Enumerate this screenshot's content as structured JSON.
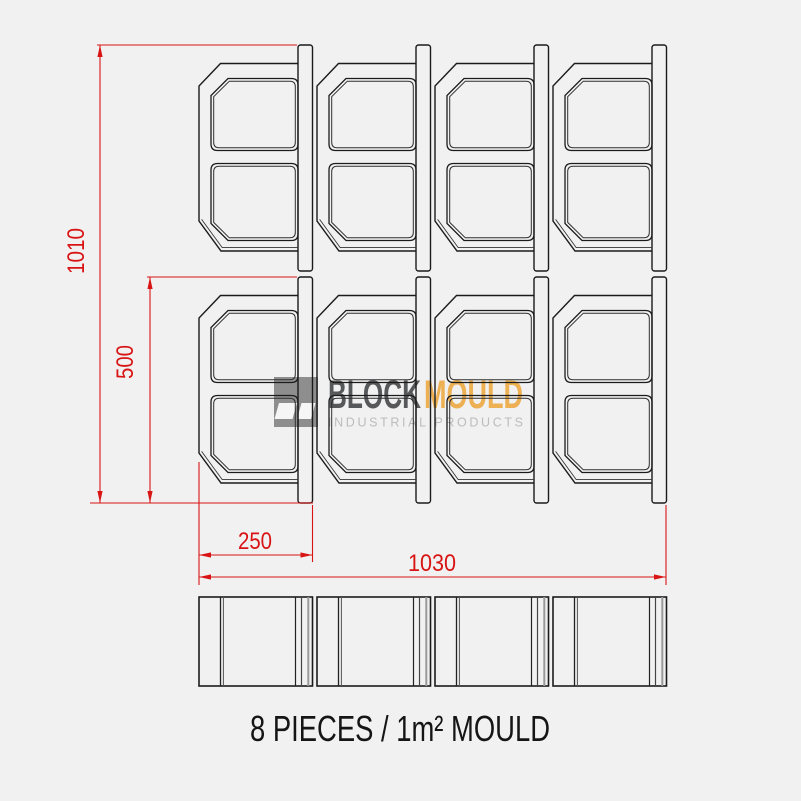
{
  "drawing": {
    "caption": "8 PIECES / 1m² MOULD",
    "grid": {
      "rows": 2,
      "columns": 4,
      "pieces_total": 8
    },
    "dimensions": {
      "overall_height": "1010",
      "piece_height": "500",
      "piece_width": "250",
      "overall_width": "1030"
    },
    "colors": {
      "background": "#f1f1f1",
      "line_black": "#1b1b1b",
      "dimension_red": "#d91414",
      "logo_dark_gray": "#57585a",
      "logo_orange": "#edb052",
      "logo_light_gray": "#bcbcbc",
      "logo_mark_gray": "#8e8e8e"
    }
  },
  "logo": {
    "word1": "BLOCK",
    "word2": "MOULD",
    "tagline": "INDUSTRIAL PRODUCTS"
  }
}
